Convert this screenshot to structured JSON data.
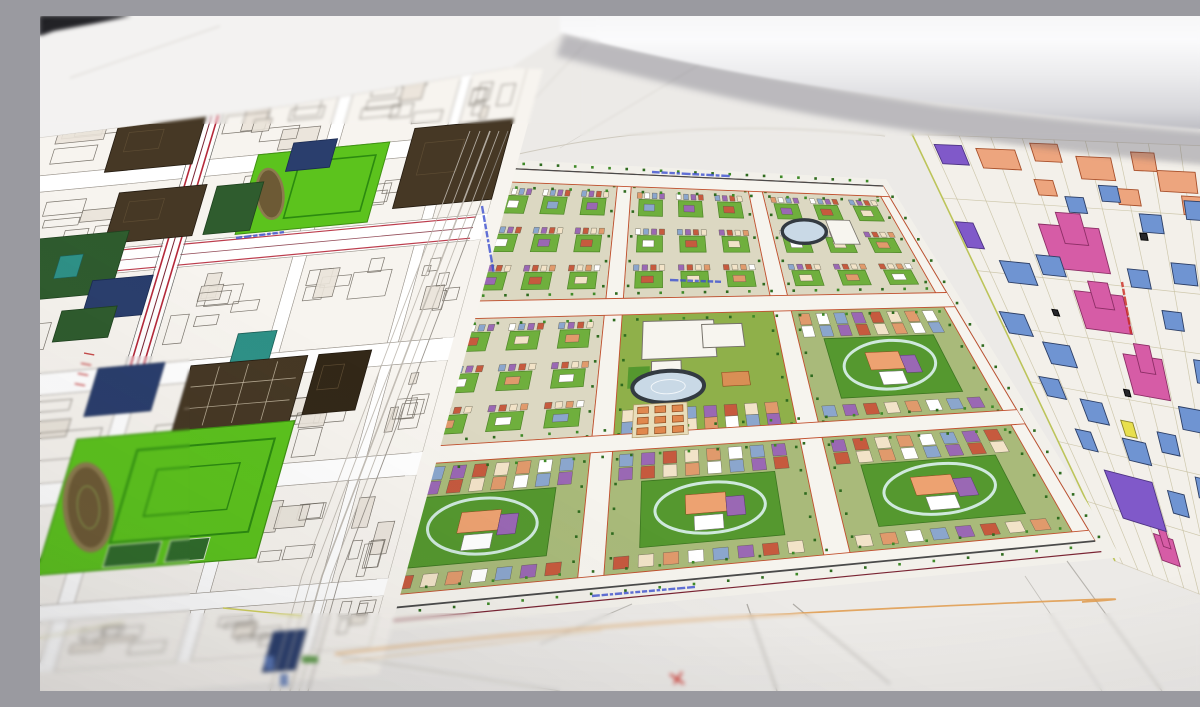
{
  "scene": {
    "description": "Photograph of printed urban master-plan drawings spread on a table: left sheet with black-line building blocks and colored parcels, a colorful green micro-district master plan in the center, a pale plan with pink, blue, purple and yellow buildings on the right, and a rolled sheet of paper lying across the top right.",
    "width": 1200,
    "height": 675
  },
  "palette": {
    "paper": "#eceae7",
    "paper_bright": "#f3f2f1",
    "dark_corner": "#232228",
    "left_bg": "#f7f4ef",
    "left_line": "#6f6961",
    "brown": "#463825",
    "brown_dark": "#332818",
    "darkgreen": "#2f5c2e",
    "navy": "#2a3e6d",
    "teal": "#2e9187",
    "bright_green": "#5cc31d",
    "track_ring": "#8c7b4e",
    "track_fill": "#6d5a35",
    "red_road": "#b5293a",
    "maroon": "#7a2433",
    "c_base": "#dcd8c2",
    "c_yard": "#6faf3d",
    "c_lawn": "#8fb04a",
    "c_green_dark": "#55982f",
    "c_street": "#f6f4ee",
    "c_edge": "#c2502e",
    "tree_a": "#3f8a28",
    "tree_b": "#2f6b1f",
    "stadium_ring": "#333a41",
    "stadium_fill": "#c9d9e6",
    "mint_ring": "#cfe9dd",
    "tiny": [
      "#e09a6c",
      "#ffffff",
      "#8ba6cd",
      "#9a68b4",
      "#c65a3e",
      "#f2e3c8"
    ],
    "r_bg": "#f3f0ea",
    "r_grid": "#c6bf9f",
    "r_blue": "#6f94d2",
    "r_blue_s": "#2d3f66",
    "r_pink": "#d65ca6",
    "r_pink_s": "#8d2f66",
    "r_purple": "#8059c9",
    "r_yellow": "#e8df4e",
    "r_yellow_s": "#8a832a",
    "r_salmon": "#eda57e",
    "r_salmon_s": "#a8502b",
    "r_dark": "#26262a",
    "label_blue": "#3b4fd0",
    "label_red": "#cc2a22",
    "orange_line": "#e09a4a"
  },
  "left_plan": {
    "quad": [
      [
        -70,
        112
      ],
      [
        475,
        58
      ],
      [
        318,
        632
      ],
      [
        -250,
        675
      ]
    ],
    "u_streets": [
      [
        0.1,
        0.125
      ],
      [
        0.435,
        0.465
      ],
      [
        0.68,
        0.705
      ],
      [
        0.9,
        0.92
      ]
    ],
    "v_streets": [
      [
        0.1,
        0.13
      ],
      [
        0.245,
        0.29
      ],
      [
        0.46,
        0.5
      ],
      [
        0.66,
        0.7
      ],
      [
        0.88,
        0.91
      ]
    ],
    "red_band": {
      "u": [
        0.435,
        0.465
      ],
      "v": [
        -0.08,
        0.48
      ]
    },
    "avenue_v": [
      0.245,
      0.29
    ],
    "parcels": [
      {
        "t": "brown",
        "u": [
          0.28,
          0.44
        ],
        "v": [
          0.02,
          0.105
        ]
      },
      {
        "t": "school_top",
        "u": [
          0.56,
          0.8
        ],
        "v": [
          0.1,
          0.24
        ]
      },
      {
        "t": "brown",
        "u": [
          0.84,
          1.02
        ],
        "v": [
          0.08,
          0.22
        ]
      },
      {
        "t": "navy",
        "u": [
          0.62,
          0.7
        ],
        "v": [
          0.085,
          0.135
        ]
      },
      {
        "t": "brown",
        "u": [
          0.32,
          0.48
        ],
        "v": [
          0.145,
          0.235
        ]
      },
      {
        "t": "darkgreen",
        "u": [
          0.5,
          0.585
        ],
        "v": [
          0.15,
          0.235
        ]
      },
      {
        "t": "dgreen_teal",
        "u": [
          0.17,
          0.36
        ],
        "v": [
          0.215,
          0.325
        ]
      },
      {
        "t": "navy",
        "u": [
          0.32,
          0.43
        ],
        "v": [
          0.3,
          0.37
        ]
      },
      {
        "t": "darkgreen",
        "u": [
          0.28,
          0.38
        ],
        "v": [
          0.35,
          0.405
        ]
      },
      {
        "t": "teal",
        "u": [
          0.62,
          0.69
        ],
        "v": [
          0.42,
          0.48
        ]
      },
      {
        "t": "navy",
        "u": [
          0.38,
          0.5
        ],
        "v": [
          0.46,
          0.545
        ]
      },
      {
        "t": "brown_grid",
        "u": [
          0.55,
          0.76
        ],
        "v": [
          0.47,
          0.585
        ]
      },
      {
        "t": "brown_d",
        "u": [
          0.78,
          0.875
        ],
        "v": [
          0.47,
          0.575
        ]
      },
      {
        "t": "school_big",
        "u": [
          0.38,
          0.77
        ],
        "v": [
          0.585,
          0.825
        ]
      },
      {
        "t": "navy",
        "u": [
          0.84,
          0.9
        ],
        "v": [
          0.96,
          1.03
        ]
      }
    ]
  },
  "center_plan": {
    "quad": [
      [
        457,
        152
      ],
      [
        843,
        170
      ],
      [
        1055,
        525
      ],
      [
        298,
        597
      ]
    ],
    "u_streets": [
      [
        0,
        0.022
      ],
      [
        0.315,
        0.35
      ],
      [
        0.645,
        0.68
      ],
      [
        0.978,
        1
      ]
    ],
    "v_streets": [
      [
        0,
        0.03
      ],
      [
        0.3,
        0.34
      ],
      [
        0.63,
        0.67
      ],
      [
        0.97,
        1
      ]
    ],
    "types": [
      [
        "res",
        "res",
        "res_stadium"
      ],
      [
        "res",
        "school",
        "res_oval"
      ],
      [
        "res_oval",
        "res_oval",
        "res_oval"
      ]
    ],
    "parcels": [
      {
        "t": "kinder",
        "u": [
          0.38,
          0.47
        ],
        "v": [
          0.56,
          0.64
        ]
      }
    ]
  },
  "right_plan": {
    "quad": [
      [
        872,
        118
      ],
      [
        1266,
        134
      ],
      [
        1266,
        620
      ],
      [
        1075,
        545
      ]
    ],
    "v_lines": [
      0.15,
      0.32,
      0.45,
      0.58,
      0.72,
      0.86
    ],
    "buildings": [
      {
        "c": "r_salmon",
        "u": 0.2,
        "v": 0.05,
        "w": 0.1,
        "h": 0.045
      },
      {
        "c": "r_salmon",
        "u": 0.33,
        "v": 0.03,
        "w": 0.07,
        "h": 0.04
      },
      {
        "c": "r_salmon",
        "u": 0.45,
        "v": 0.06,
        "w": 0.09,
        "h": 0.05
      },
      {
        "c": "r_salmon",
        "u": 0.58,
        "v": 0.04,
        "w": 0.06,
        "h": 0.04
      },
      {
        "c": "r_salmon",
        "u": 0.66,
        "v": 0.08,
        "w": 0.1,
        "h": 0.045
      },
      {
        "c": "r_salmon",
        "u": 0.78,
        "v": 0.06,
        "w": 0.07,
        "h": 0.04
      },
      {
        "c": "r_salmon",
        "u": 0.88,
        "v": 0.1,
        "w": 0.08,
        "h": 0.05
      },
      {
        "c": "r_salmon",
        "u": 0.3,
        "v": 0.11,
        "w": 0.05,
        "h": 0.035
      },
      {
        "c": "r_salmon",
        "u": 0.52,
        "v": 0.12,
        "w": 0.06,
        "h": 0.035
      },
      {
        "c": "r_salmon",
        "u": 0.71,
        "v": 0.13,
        "w": 0.09,
        "h": 0.04
      },
      {
        "c": "r_pink",
        "u": 0.33,
        "v": 0.245,
        "w": 0.17,
        "h": 0.1,
        "zig": 1
      },
      {
        "c": "r_pink",
        "u": 0.36,
        "v": 0.385,
        "w": 0.15,
        "h": 0.085,
        "zig": 1
      },
      {
        "c": "r_pink",
        "u": 0.45,
        "v": 0.52,
        "w": 0.13,
        "h": 0.09,
        "zig": 1
      },
      {
        "c": "r_pink",
        "u": 0.33,
        "v": 0.92,
        "w": 0.09,
        "h": 0.06,
        "zig": 1
      },
      {
        "c": "r_purple",
        "u": 0.03,
        "v": 0.235,
        "w": 0.05,
        "h": 0.06
      },
      {
        "c": "r_purple",
        "u": 0.08,
        "v": 0.045,
        "w": 0.07,
        "h": 0.045
      },
      {
        "c": "r_purple",
        "u": 0.255,
        "v": 0.82,
        "w": 0.2,
        "h": 0.11
      },
      {
        "c": "r_purple",
        "u": 0.67,
        "v": 0.82,
        "w": 0.22,
        "h": 0.11
      },
      {
        "c": "r_yellow",
        "u": 0.775,
        "v": 0.165,
        "w": 0.08,
        "h": 0.06
      },
      {
        "c": "r_yellow",
        "u": 0.84,
        "v": 0.39,
        "w": 0.06,
        "h": 0.05
      },
      {
        "c": "r_yellow",
        "u": 0.325,
        "v": 0.65,
        "w": 0.045,
        "h": 0.035
      },
      {
        "c": "r_yellow",
        "u": 0.96,
        "v": 0.6,
        "w": 0.05,
        "h": 0.05
      },
      {
        "c": "r_blue",
        "u": 0.13,
        "v": 0.315,
        "w": 0.09,
        "h": 0.05
      },
      {
        "c": "r_blue",
        "u": 0.24,
        "v": 0.29,
        "w": 0.07,
        "h": 0.045
      },
      {
        "c": "r_blue",
        "u": 0.05,
        "v": 0.44,
        "w": 0.08,
        "h": 0.05
      },
      {
        "c": "r_blue",
        "u": 0.16,
        "v": 0.5,
        "w": 0.09,
        "h": 0.05
      },
      {
        "c": "r_blue",
        "u": 0.08,
        "v": 0.585,
        "w": 0.07,
        "h": 0.045
      },
      {
        "c": "r_blue",
        "u": 0.21,
        "v": 0.625,
        "w": 0.08,
        "h": 0.05
      },
      {
        "c": "r_blue",
        "u": 0.33,
        "v": 0.7,
        "w": 0.09,
        "h": 0.05
      },
      {
        "c": "r_blue",
        "u": 0.47,
        "v": 0.665,
        "w": 0.07,
        "h": 0.045
      },
      {
        "c": "r_blue",
        "u": 0.58,
        "v": 0.6,
        "w": 0.08,
        "h": 0.05
      },
      {
        "c": "r_blue",
        "u": 0.66,
        "v": 0.49,
        "w": 0.07,
        "h": 0.05
      },
      {
        "c": "r_blue",
        "u": 0.58,
        "v": 0.385,
        "w": 0.06,
        "h": 0.04
      },
      {
        "c": "r_blue",
        "u": 0.5,
        "v": 0.3,
        "w": 0.06,
        "h": 0.04
      },
      {
        "c": "r_blue",
        "u": 0.64,
        "v": 0.28,
        "w": 0.07,
        "h": 0.045
      },
      {
        "c": "r_blue",
        "u": 0.57,
        "v": 0.175,
        "w": 0.06,
        "h": 0.04
      },
      {
        "c": "r_blue",
        "u": 0.37,
        "v": 0.145,
        "w": 0.05,
        "h": 0.035
      },
      {
        "c": "r_blue",
        "u": 0.47,
        "v": 0.115,
        "w": 0.05,
        "h": 0.035
      },
      {
        "c": "r_blue",
        "u": 0.7,
        "v": 0.14,
        "w": 0.06,
        "h": 0.04
      },
      {
        "c": "r_blue",
        "u": 0.82,
        "v": 0.28,
        "w": 0.06,
        "h": 0.045
      },
      {
        "c": "r_blue",
        "u": 0.9,
        "v": 0.16,
        "w": 0.05,
        "h": 0.04
      },
      {
        "c": "r_blue",
        "u": 0.13,
        "v": 0.7,
        "w": 0.06,
        "h": 0.045
      },
      {
        "c": "r_blue",
        "u": 0.45,
        "v": 0.8,
        "w": 0.07,
        "h": 0.05
      },
      {
        "c": "r_blue",
        "u": 0.58,
        "v": 0.75,
        "w": 0.06,
        "h": 0.045
      },
      {
        "c": "r_dark",
        "u": 0.54,
        "v": 0.205,
        "w": 0.02,
        "h": 0.015
      },
      {
        "c": "r_dark",
        "u": 0.36,
        "v": 0.565,
        "w": 0.02,
        "h": 0.015
      },
      {
        "c": "r_dark",
        "u": 0.2,
        "v": 0.4,
        "w": 0.018,
        "h": 0.014
      }
    ]
  },
  "gap_avenue": {
    "spine": [
      [
        468,
        115
      ],
      [
        383,
        340
      ],
      [
        300,
        560
      ],
      [
        268,
        675
      ]
    ],
    "offsets": [
      0,
      -9,
      -18,
      -28,
      -38
    ]
  },
  "overlays": {
    "lines": [
      [
        238,
        96,
        462,
        54,
        "#c9c5bf",
        1,
        0.9
      ],
      [
        30,
        62,
        180,
        10,
        "#d6d2cc",
        1,
        0.9
      ],
      [
        460,
        120,
        560,
        12,
        "#d0ccc6",
        0.7,
        0.8
      ],
      [
        520,
        132,
        704,
        22,
        "#d0ccc6",
        0.7,
        0.7
      ],
      [
        300,
        640,
        520,
        675,
        "#b9b6b0",
        1,
        0.9
      ],
      [
        500,
        628,
        592,
        588,
        "#b9b6b0",
        1,
        0.9
      ],
      [
        707,
        588,
        737,
        675,
        "#a9a6a0",
        1.3,
        0.9
      ],
      [
        753,
        588,
        850,
        668,
        "#a9a6a0",
        1.2,
        0.9
      ],
      [
        1027,
        545,
        1122,
        675,
        "#b2afa9",
        1.1,
        0.9
      ],
      [
        985,
        560,
        1062,
        675,
        "#bcb9b3",
        0.9,
        0.8
      ],
      [
        183,
        592,
        262,
        600,
        "#cfcf4f",
        1.5,
        0.9
      ],
      [
        0,
        622,
        84,
        606,
        "#d4d09a",
        1.3,
        0.8
      ]
    ],
    "paths": [
      {
        "d": "M470,140 Q650,98 845,120",
        "c": "#cfcabf",
        "w": 0.9
      },
      {
        "d": "M880,36 Q960,62 1046,94",
        "c": "#d8cba0",
        "w": 1.4
      },
      {
        "d": "M892,22 Q930,44 962,62",
        "c": "#d8cba0",
        "w": 1.1
      },
      {
        "d": "M295,638 Q560,606 860,592 T1042,586",
        "c": "#e09a4a",
        "w": 1.7
      },
      {
        "d": "M302,646 Q450,628 562,614",
        "c": "#e0b070",
        "w": 0.8
      }
    ],
    "red_mark": [
      [
        630,
        658,
        644,
        668
      ],
      [
        634,
        668,
        642,
        656
      ]
    ],
    "labels": [
      {
        "x": 196,
        "y": 222,
        "rot": -7,
        "len": 46,
        "c": "label_blue"
      },
      {
        "x": 442,
        "y": 190,
        "rot": 80,
        "len": 68,
        "c": "label_blue"
      },
      {
        "x": 612,
        "y": 156,
        "rot": 3,
        "len": 78,
        "c": "label_blue"
      },
      {
        "x": 630,
        "y": 264,
        "rot": 2,
        "len": 46,
        "c": "label_blue"
      },
      {
        "x": 552,
        "y": 580,
        "rot": -5,
        "len": 100,
        "c": "label_blue"
      },
      {
        "x": 1082,
        "y": 266,
        "rot": 80,
        "len": 48,
        "c": "label_red"
      }
    ]
  },
  "photo": {
    "top_sheet": [
      [
        0,
        12
      ],
      [
        88,
        0
      ],
      [
        540,
        0
      ],
      [
        540,
        6
      ],
      [
        470,
        52
      ],
      [
        250,
        90
      ],
      [
        0,
        122
      ]
    ],
    "top_sheet_edge": [
      [
        0,
        122
      ],
      [
        250,
        90
      ],
      [
        470,
        52
      ]
    ],
    "dark_corner": [
      [
        0,
        0
      ],
      [
        92,
        0
      ],
      [
        52,
        8
      ],
      [
        14,
        15
      ],
      [
        0,
        20
      ]
    ],
    "roll_body": "M520,-14 L1266,-14 L1266,120 C1150,114 1000,100 860,82 C720,64 600,38 520,16 Z",
    "roll_shadow": "M524,18 C620,38 760,68 900,90 C1050,107 1180,118 1266,124 L1266,156 C1150,150 980,132 840,110 C700,88 598,60 516,40 Z"
  }
}
